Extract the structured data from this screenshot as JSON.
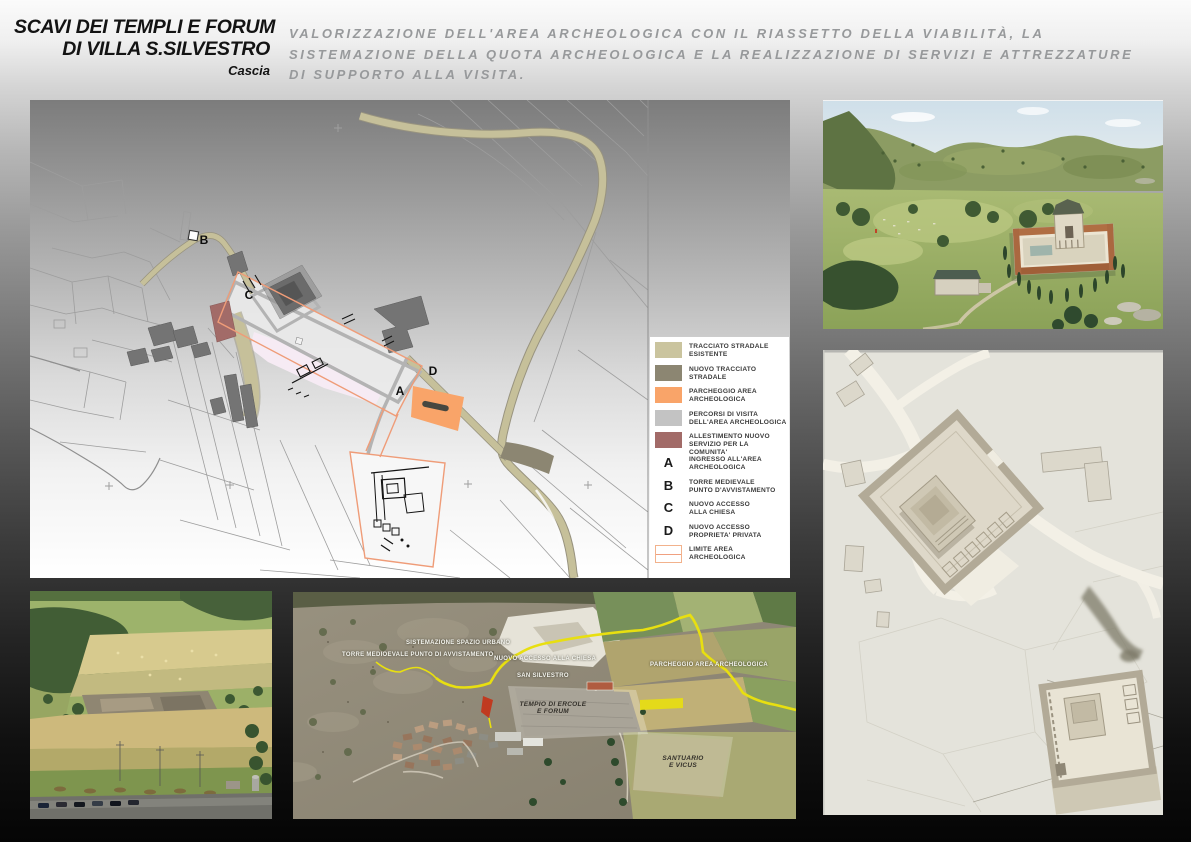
{
  "header": {
    "title_line1": "SCAVI DEI TEMPLI E FORUM",
    "title_line2": "DI VILLA S.SILVESTRO",
    "subtitle": "Cascia",
    "description": [
      "VALORIZZAZIONE DELL'AREA ARCHEOLOGICA CON IL RIASSETTO DELLA VIABILITÀ, LA",
      "SISTEMAZIONE DELLA QUOTA ARCHEOLOGICA E LA REALIZZAZIONE DI SERVIZI E ATTREZZATURE",
      "DI SUPPORTO ALLA VISITA."
    ]
  },
  "map": {
    "markers": {
      "a": "A",
      "b": "B",
      "c": "C",
      "d": "D"
    }
  },
  "legend": {
    "items": [
      {
        "label1": "TRACCIATO STRADALE",
        "label2": "ESISTENTE"
      },
      {
        "label1": "NUOVO TRACCIATO",
        "label2": "STRADALE"
      },
      {
        "label1": "PARCHEGGIO AREA",
        "label2": "ARCHEOLOGICA"
      },
      {
        "label1": "PERCORSI DI VISITA",
        "label2": "DELL'AREA ARCHEOLOGICA"
      },
      {
        "label1": "ALLESTIMENTO NUOVO",
        "label2": "SERVIZIO PER LA COMUNITA'"
      },
      {
        "letter": "A",
        "label1": "INGRESSO ALL'AREA",
        "label2": "ARCHEOLOGICA"
      },
      {
        "letter": "B",
        "label1": "TORRE MEDIEVALE",
        "label2": "PUNTO D'AVVISTAMENTO"
      },
      {
        "letter": "C",
        "label1": "NUOVO ACCESSO",
        "label2": "ALLA CHIESA"
      },
      {
        "letter": "D",
        "label1": "NUOVO ACCESSO",
        "label2": "PROPRIETA' PRIVATA"
      },
      {
        "label1": "LIMITE AREA",
        "label2": "ARCHEOLOGICA"
      }
    ],
    "colors": {
      "existing_road": "#cac49e",
      "new_road": "#8c8672",
      "parking": "#f9a469",
      "visit_paths": "#c3c3c3",
      "community_service": "#a26b68",
      "area_limit": "#f0a080"
    }
  },
  "aerial": {
    "labels": {
      "sistemazione": "SISTEMAZIONE SPAZIO URBANO",
      "torre": "TORRE MEDIOEVALE PUNTO DI AVVISTAMENTO",
      "nuovo_accesso": "NUOVO ACCESSO ALLA CHIESA",
      "san_silvestro": "SAN SILVESTRO",
      "parcheggio": "PARCHEGGIO AREA ARCHEOLOGICA",
      "tempio_line1": "TEMPIO DI ERCOLE",
      "tempio_line2": "E FORUM",
      "santuario_line1": "SANTUARIO",
      "santuario_line2": "E VICUS"
    },
    "route_color": "#e8df10"
  }
}
